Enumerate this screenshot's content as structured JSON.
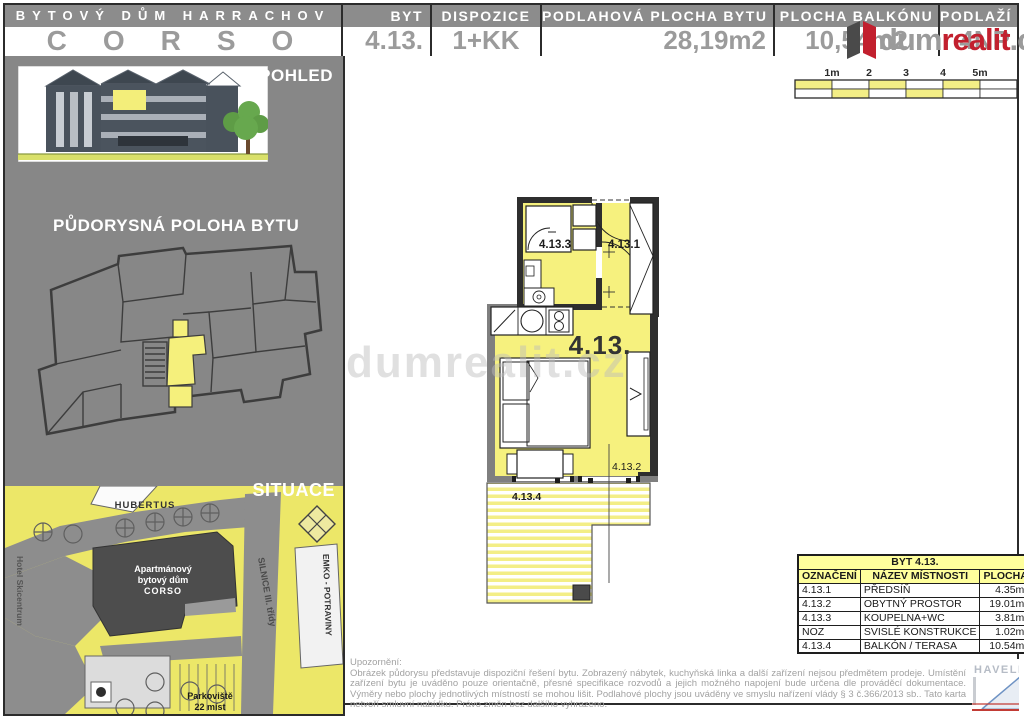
{
  "header": {
    "building_label": "BYTOVÝ DŮM HARRACHOV",
    "building_name": "CORSO",
    "columns": [
      {
        "label": "BYT",
        "value": "4.13."
      },
      {
        "label": "DISPOZICE",
        "value": "1+KK"
      },
      {
        "label": "PODLAHOVÁ PLOCHA BYTU",
        "value": "28,19m2"
      },
      {
        "label": "PLOCHA BALKÓNU",
        "value": "10,54m2"
      },
      {
        "label": "PODLAŽÍ",
        "value": "4NP"
      }
    ]
  },
  "brand": {
    "dum": "dum",
    "realit": "realit",
    "cz": ".cz",
    "watermark": "dumrealit.cz"
  },
  "sidebar": {
    "pohled_label": "POHLED",
    "pudorys_label": "PŮDORYSNÁ POLOHA BYTU",
    "situace_label": "SITUACE",
    "map": {
      "hubertus": "HUBERTUS",
      "hotel": "Hotel Skicentrum",
      "building1": "Apartmánový",
      "building2": "bytový dům",
      "building3": "CORSO",
      "silnice": "SILNICE III. třídy",
      "emko": "EMKO - POTRAVINY",
      "parking1": "Parkoviště",
      "parking2": "22 míst"
    }
  },
  "scalebar": {
    "labels": [
      "1m",
      "2",
      "3",
      "4",
      "5m"
    ]
  },
  "plan": {
    "unit": "4.13.",
    "room1": "4.13.1",
    "room2": "4.13.2",
    "room3": "4.13.3",
    "room4": "4.13.4"
  },
  "table": {
    "title": "BYT 4.13.",
    "headers": [
      "OZNAČENÍ",
      "NÁZEV MÍSTNOSTI",
      "PLOCHA"
    ],
    "rows": [
      {
        "code": "4.13.1",
        "name": "PŘEDSÍŇ",
        "area": "4.35m²"
      },
      {
        "code": "4.13.2",
        "name": "OBYTNÝ PROSTOR",
        "area": "19.01m²"
      },
      {
        "code": "4.13.3",
        "name": "KOUPELNA+WC",
        "area": "3.81m²"
      },
      {
        "code": "NOZ",
        "name": "SVISLÉ KONSTRUKCE",
        "area": "1.02m²"
      },
      {
        "code": "4.13.4",
        "name": "BALKÓN / TERASA",
        "area": "10.54m²"
      }
    ]
  },
  "disclaimer": {
    "title": "Upozornění:",
    "body": "Obrázek půdorysu představuje dispoziční řešení bytu. Zobrazený nábytek, kuchyňská linka a další zařízení nejsou předmětem prodeje. Umístění zařízení bytu je uváděno pouze orientačně, přesné specifikace rozvodů a jejich možného napojení bude určena dle prováděcí dokumentace. Výměry nebo plochy jednotlivých místností se mohou lišit. Podlahové plochy jsou uváděny ve smyslu nařízení vlády § 3 č.366/2013 sb.. Tato karta netvoří smluvní nabídku. Právo změn bez dalšího vyhrazeno."
  },
  "architect": {
    "name": "HAVELKA"
  },
  "colors": {
    "room_yellow": "#f6f17e",
    "table_yellow": "#ffff9c",
    "logo_red": "#c2202e",
    "panel_gray": "#878787"
  }
}
